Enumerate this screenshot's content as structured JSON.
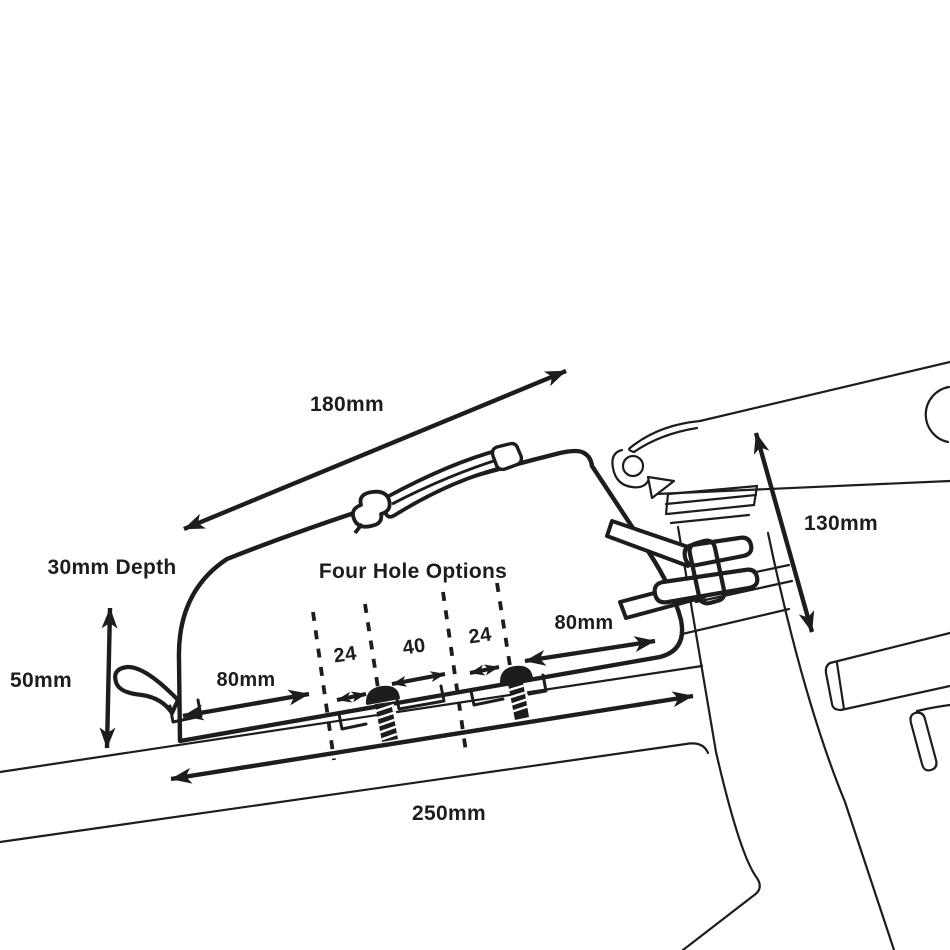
{
  "diagram": {
    "type": "technical-dimension-drawing",
    "subject": "top-tube-bag-mounted-on-bicycle-frame",
    "colors": {
      "ink": "#1d1d1b",
      "background": "#ffffff"
    },
    "labels": {
      "top_width": "180mm",
      "depth": "30mm Depth",
      "front_height": "50mm",
      "hole_options_title": "Four Hole Options",
      "left_span": "80mm",
      "right_span": "80mm",
      "hole_gap_1": "24",
      "hole_gap_2": "40",
      "hole_gap_3": "24",
      "stem_height": "130mm",
      "base_length": "250mm"
    }
  }
}
